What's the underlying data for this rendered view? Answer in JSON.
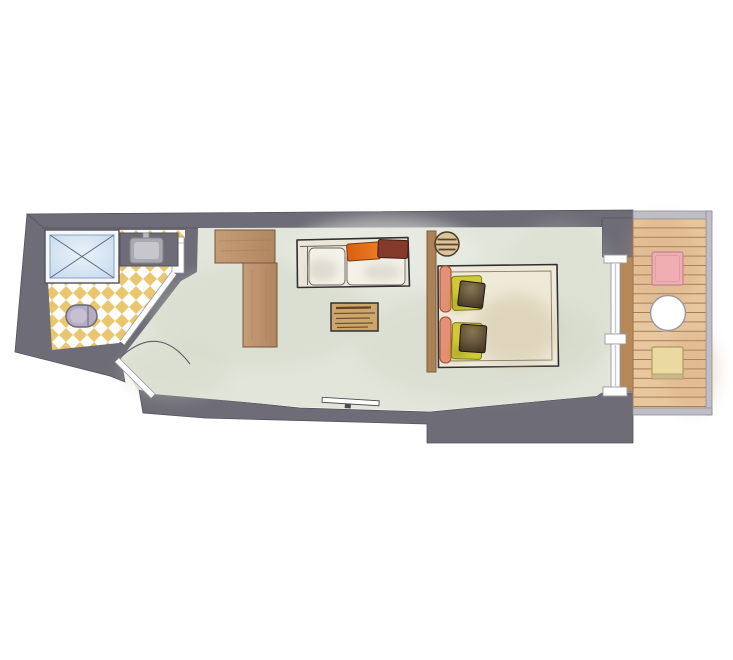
{
  "title": "Watercolor hotel-room floor plan with bathroom, living-sleeping room and balcony",
  "colors": {
    "wall": "#6e6d77",
    "wallEdge": "#54535c",
    "railFill": "#bfbec5",
    "railEdge": "#8e8d95",
    "roomFloor": "#e2e5da",
    "floorShade": "#c9d1bc",
    "floorLight": "#edefe6",
    "checkerYellow": "#eac76f",
    "bathWhite": "#ffffff",
    "showerBlue": "#c9dbee",
    "showerBlueLight": "#eaf2f9",
    "showerEdge": "#8ba2bd",
    "showerCross": "#5d6d85",
    "basinGray": "#a9a9b0",
    "basinLight": "#c6c6cc",
    "toilet": "#b4adc2",
    "toiletEdge": "#6a6779",
    "toiletHighlight": "#c9c3d6",
    "ink": "#2e2e33",
    "wood": "#bf9670",
    "woodEdge": "#74583c",
    "woodStreak": "#a87f58",
    "deck": "#e9c79e",
    "deckLine": "#a57c50",
    "deckShade": "#c89a6e",
    "threshold": "#b7895a",
    "thresholdEdge": "#8a6a44",
    "headboard": "#ab8157",
    "stool": "#d9c49c",
    "stoolLine": "#5f4226",
    "sofaBody": "#eae6da",
    "cushion": "#f4f1e8",
    "cushionShade": "#c9c5ba",
    "cushionEdge": "#6b665d",
    "orange": "#ee7c24",
    "orangeDeep": "#d95f10",
    "orangeEdge": "#7a3c0f",
    "maroon": "#84392a",
    "maroonEdge": "#3f1d14",
    "tableWood": "#cda66b",
    "tableStreak": "#5f4427",
    "linen": "#efe9d7",
    "linenShade": "#cfc3a3",
    "salmon": "#e49175",
    "salmonEdge": "#a14f35",
    "pillowYellow": "#cfc93a",
    "pillowYellowShade": "#98941f",
    "pillowYellowEdge": "#7b771b",
    "pillowDark": "#423524",
    "pillowDarkHi": "#8a7853",
    "chairPink": "#f0aeb3",
    "chairPinkEdge": "#c08490",
    "chairYellow": "#ead9a0",
    "chairYellowEdge": "#b1995f",
    "chairYellowFoot": "#c9b88d",
    "frameEdge": "#9a99a2",
    "doorArc": "#5a5a62",
    "tvEdge": "#4a4a52",
    "white": "#ffffff"
  },
  "plan": {
    "rooms": [
      {
        "name": "bathroom"
      },
      {
        "name": "living-sleeping-room"
      },
      {
        "name": "balcony"
      }
    ],
    "fixtures": {
      "bathroom": [
        "shower",
        "washbasin",
        "toilet"
      ],
      "room": [
        "wardrobe",
        "sofa",
        "orange-cushion",
        "maroon-cushion",
        "coffee-table",
        "tv-board",
        "headboard",
        "round-side-stool",
        "double-bed",
        "bolster-cushions",
        "yellow-pillows",
        "dark-pillows"
      ],
      "balcony": [
        "wood-deck",
        "pink-chair",
        "round-table",
        "yellow-chair"
      ]
    },
    "doors": [
      "entrance-door",
      "bathroom-door",
      "balcony-window-door"
    ]
  }
}
